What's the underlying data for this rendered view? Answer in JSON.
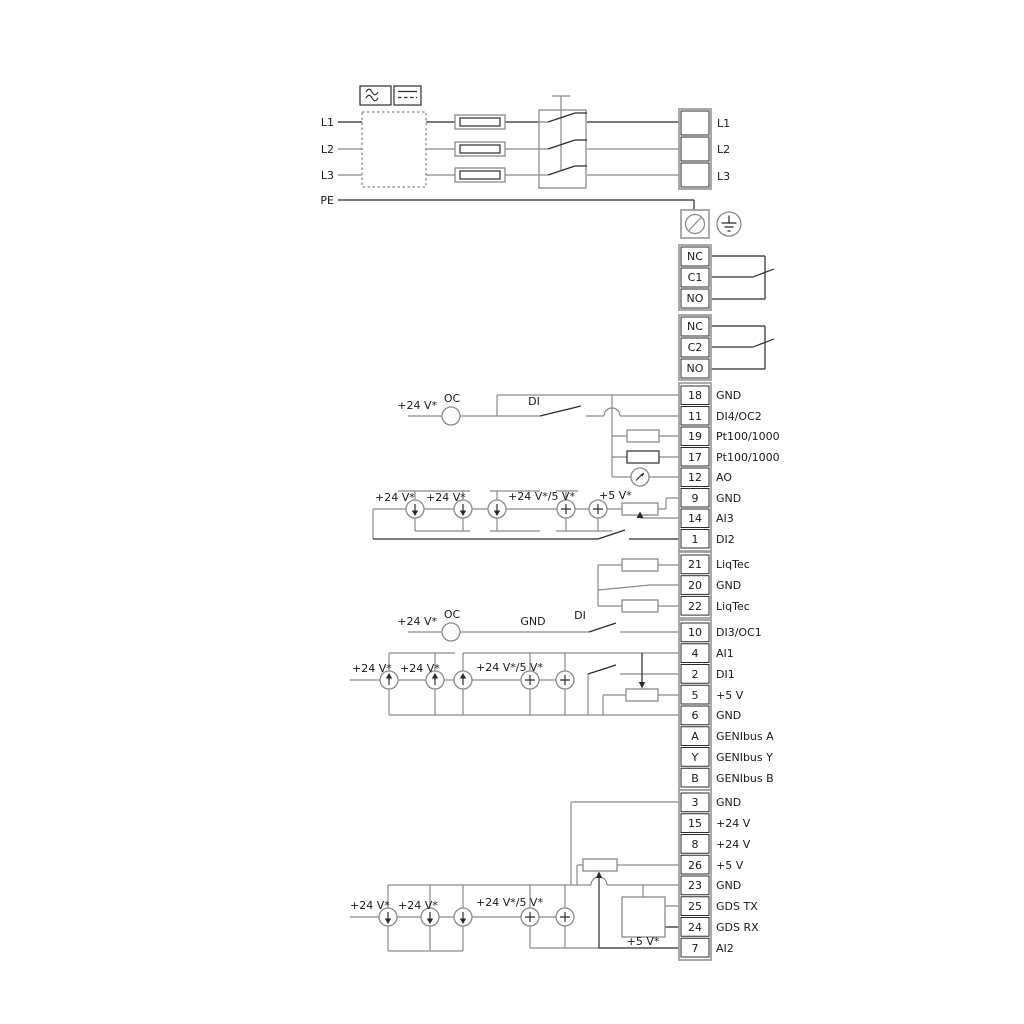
{
  "colors": {
    "background": "#ffffff",
    "wire_gray": "#8a8a8a",
    "wire_black": "#2b2b2b",
    "box_gray": "#9a9a9a"
  },
  "power": {
    "inputs": [
      "L1",
      "L2",
      "L3",
      "PE"
    ],
    "outputs": [
      "L1",
      "L2",
      "L3"
    ]
  },
  "relays": {
    "relay1": {
      "nc": "NC",
      "c": "C1",
      "no": "NO"
    },
    "relay2": {
      "nc": "NC",
      "c": "C2",
      "no": "NO"
    }
  },
  "strip_io1": {
    "rows": [
      {
        "num": "18",
        "name": "GND"
      },
      {
        "num": "11",
        "name": "DI4/OC2"
      },
      {
        "num": "19",
        "name": "Pt100/1000"
      },
      {
        "num": "17",
        "name": "Pt100/1000"
      },
      {
        "num": "12",
        "name": "AO"
      },
      {
        "num": "9",
        "name": "GND"
      },
      {
        "num": "14",
        "name": "AI3"
      },
      {
        "num": "1",
        "name": "DI2"
      }
    ]
  },
  "strip_liqtec": {
    "rows": [
      {
        "num": "21",
        "name": "LiqTec"
      },
      {
        "num": "20",
        "name": "GND"
      },
      {
        "num": "22",
        "name": "LiqTec"
      }
    ]
  },
  "strip_io2": {
    "rows": [
      {
        "num": "10",
        "name": "DI3/OC1"
      },
      {
        "num": "4",
        "name": "AI1"
      },
      {
        "num": "2",
        "name": "DI1"
      },
      {
        "num": "5",
        "name": "+5 V"
      },
      {
        "num": "6",
        "name": "GND"
      },
      {
        "num": "A",
        "name": "GENIbus A"
      },
      {
        "num": "Y",
        "name": "GENIbus Y"
      },
      {
        "num": "B",
        "name": "GENIbus B"
      }
    ]
  },
  "strip_io3": {
    "rows": [
      {
        "num": "3",
        "name": "GND"
      },
      {
        "num": "15",
        "name": "+24 V"
      },
      {
        "num": "8",
        "name": "+24 V"
      },
      {
        "num": "26",
        "name": "+5 V"
      },
      {
        "num": "23",
        "name": "GND"
      },
      {
        "num": "25",
        "name": "GDS TX"
      },
      {
        "num": "24",
        "name": "GDS RX"
      },
      {
        "num": "7",
        "name": "AI2"
      }
    ]
  },
  "labels": {
    "g18": {
      "v24": "+24 V*",
      "oc": "OC",
      "di": "DI"
    },
    "g9": {
      "v24a": "+24 V*",
      "v24b": "+24 V*",
      "v245": "+24 V*/5 V*",
      "v5": "+5 V*"
    },
    "g10": {
      "v24": "+24 V*",
      "oc": "OC",
      "gnd": "GND",
      "di": "DI"
    },
    "g4": {
      "v24a": "+24 V*",
      "v24b": "+24 V*",
      "v245": "+24 V*/5 V*"
    },
    "g3": {
      "v24a": "+24 V*",
      "v24b": "+24 V*",
      "v245": "+24 V*/5 V*",
      "v5": "+5 V*"
    }
  }
}
